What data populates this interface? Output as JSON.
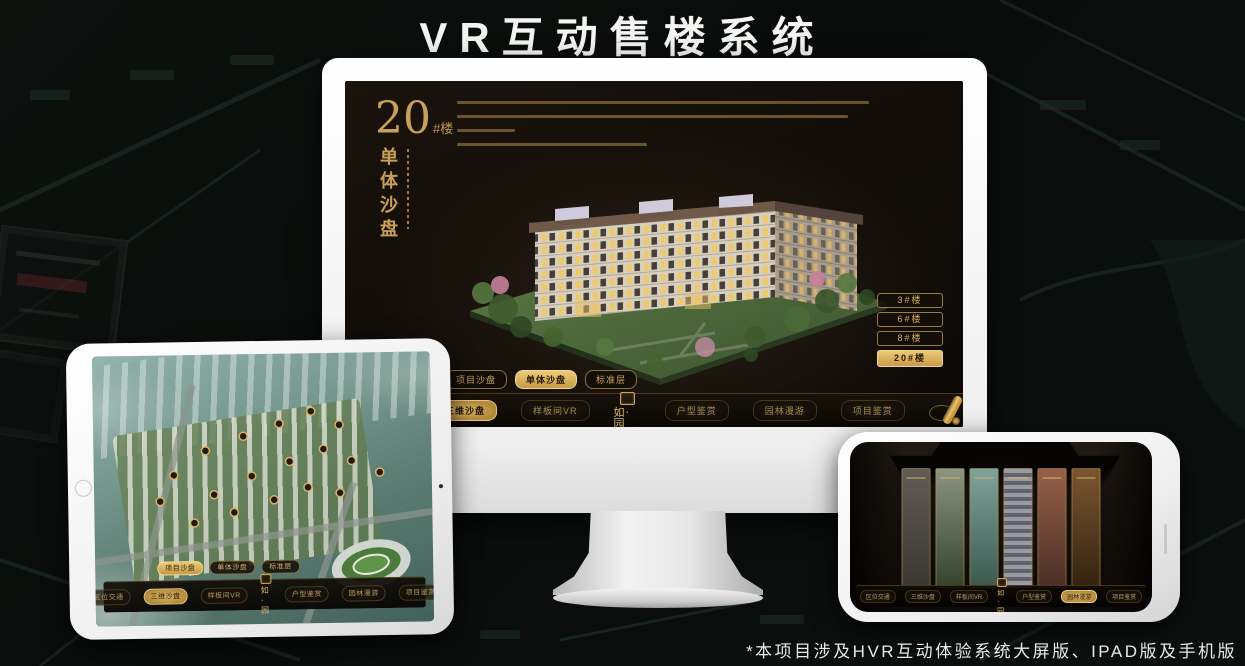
{
  "page": {
    "title": "VR互动售楼系统",
    "footnote": "*本项目涉及HVR互动体验系统大屏版、IPAD版及手机版"
  },
  "colors": {
    "gold": "#c9a25e",
    "gold_active": "#d8b260",
    "active_text": "#241806",
    "screen_bg": "#120d08",
    "title_text": "#f4f4f2"
  },
  "monitor": {
    "headline": {
      "number": "20",
      "suffix": "#楼",
      "subtitle": "单体沙盘"
    },
    "floor_buttons": [
      {
        "label": "3#楼",
        "active": false
      },
      {
        "label": "6#楼",
        "active": false
      },
      {
        "label": "8#楼",
        "active": false
      },
      {
        "label": "20#楼",
        "active": true
      }
    ],
    "sub_tabs": [
      {
        "label": "项目沙盘",
        "active": false
      },
      {
        "label": "单体沙盘",
        "active": true
      },
      {
        "label": "标准层",
        "active": false
      }
    ],
    "nav_items": [
      {
        "label": "区位交通",
        "active": false
      },
      {
        "label": "三维沙盘",
        "active": true
      },
      {
        "label": "样板间VR",
        "active": false
      },
      {
        "label": "户型鉴赏",
        "active": false
      },
      {
        "label": "园林漫游",
        "active": false
      },
      {
        "label": "项目鉴赏",
        "active": false
      }
    ],
    "logo_text": "如·园"
  },
  "tablet": {
    "sub_tabs": [
      {
        "label": "项目沙盘",
        "active": true
      },
      {
        "label": "单体沙盘",
        "active": false
      },
      {
        "label": "标准层",
        "active": false
      }
    ],
    "nav_items": [
      {
        "label": "区位交通",
        "active": false
      },
      {
        "label": "三维沙盘",
        "active": true
      },
      {
        "label": "样板间VR",
        "active": false
      },
      {
        "label": "户型鉴赏",
        "active": false
      },
      {
        "label": "园林漫游",
        "active": false
      },
      {
        "label": "项目鉴赏",
        "active": false
      }
    ],
    "logo_text": "如·园"
  },
  "phone": {
    "nav_items": [
      {
        "label": "区位交通",
        "active": false
      },
      {
        "label": "三维沙盘",
        "active": false
      },
      {
        "label": "样板间VR",
        "active": false
      },
      {
        "label": "户型鉴赏",
        "active": false
      },
      {
        "label": "园林漫游",
        "active": true
      },
      {
        "label": "项目鉴赏",
        "active": false
      }
    ],
    "logo_text": "如·园"
  }
}
